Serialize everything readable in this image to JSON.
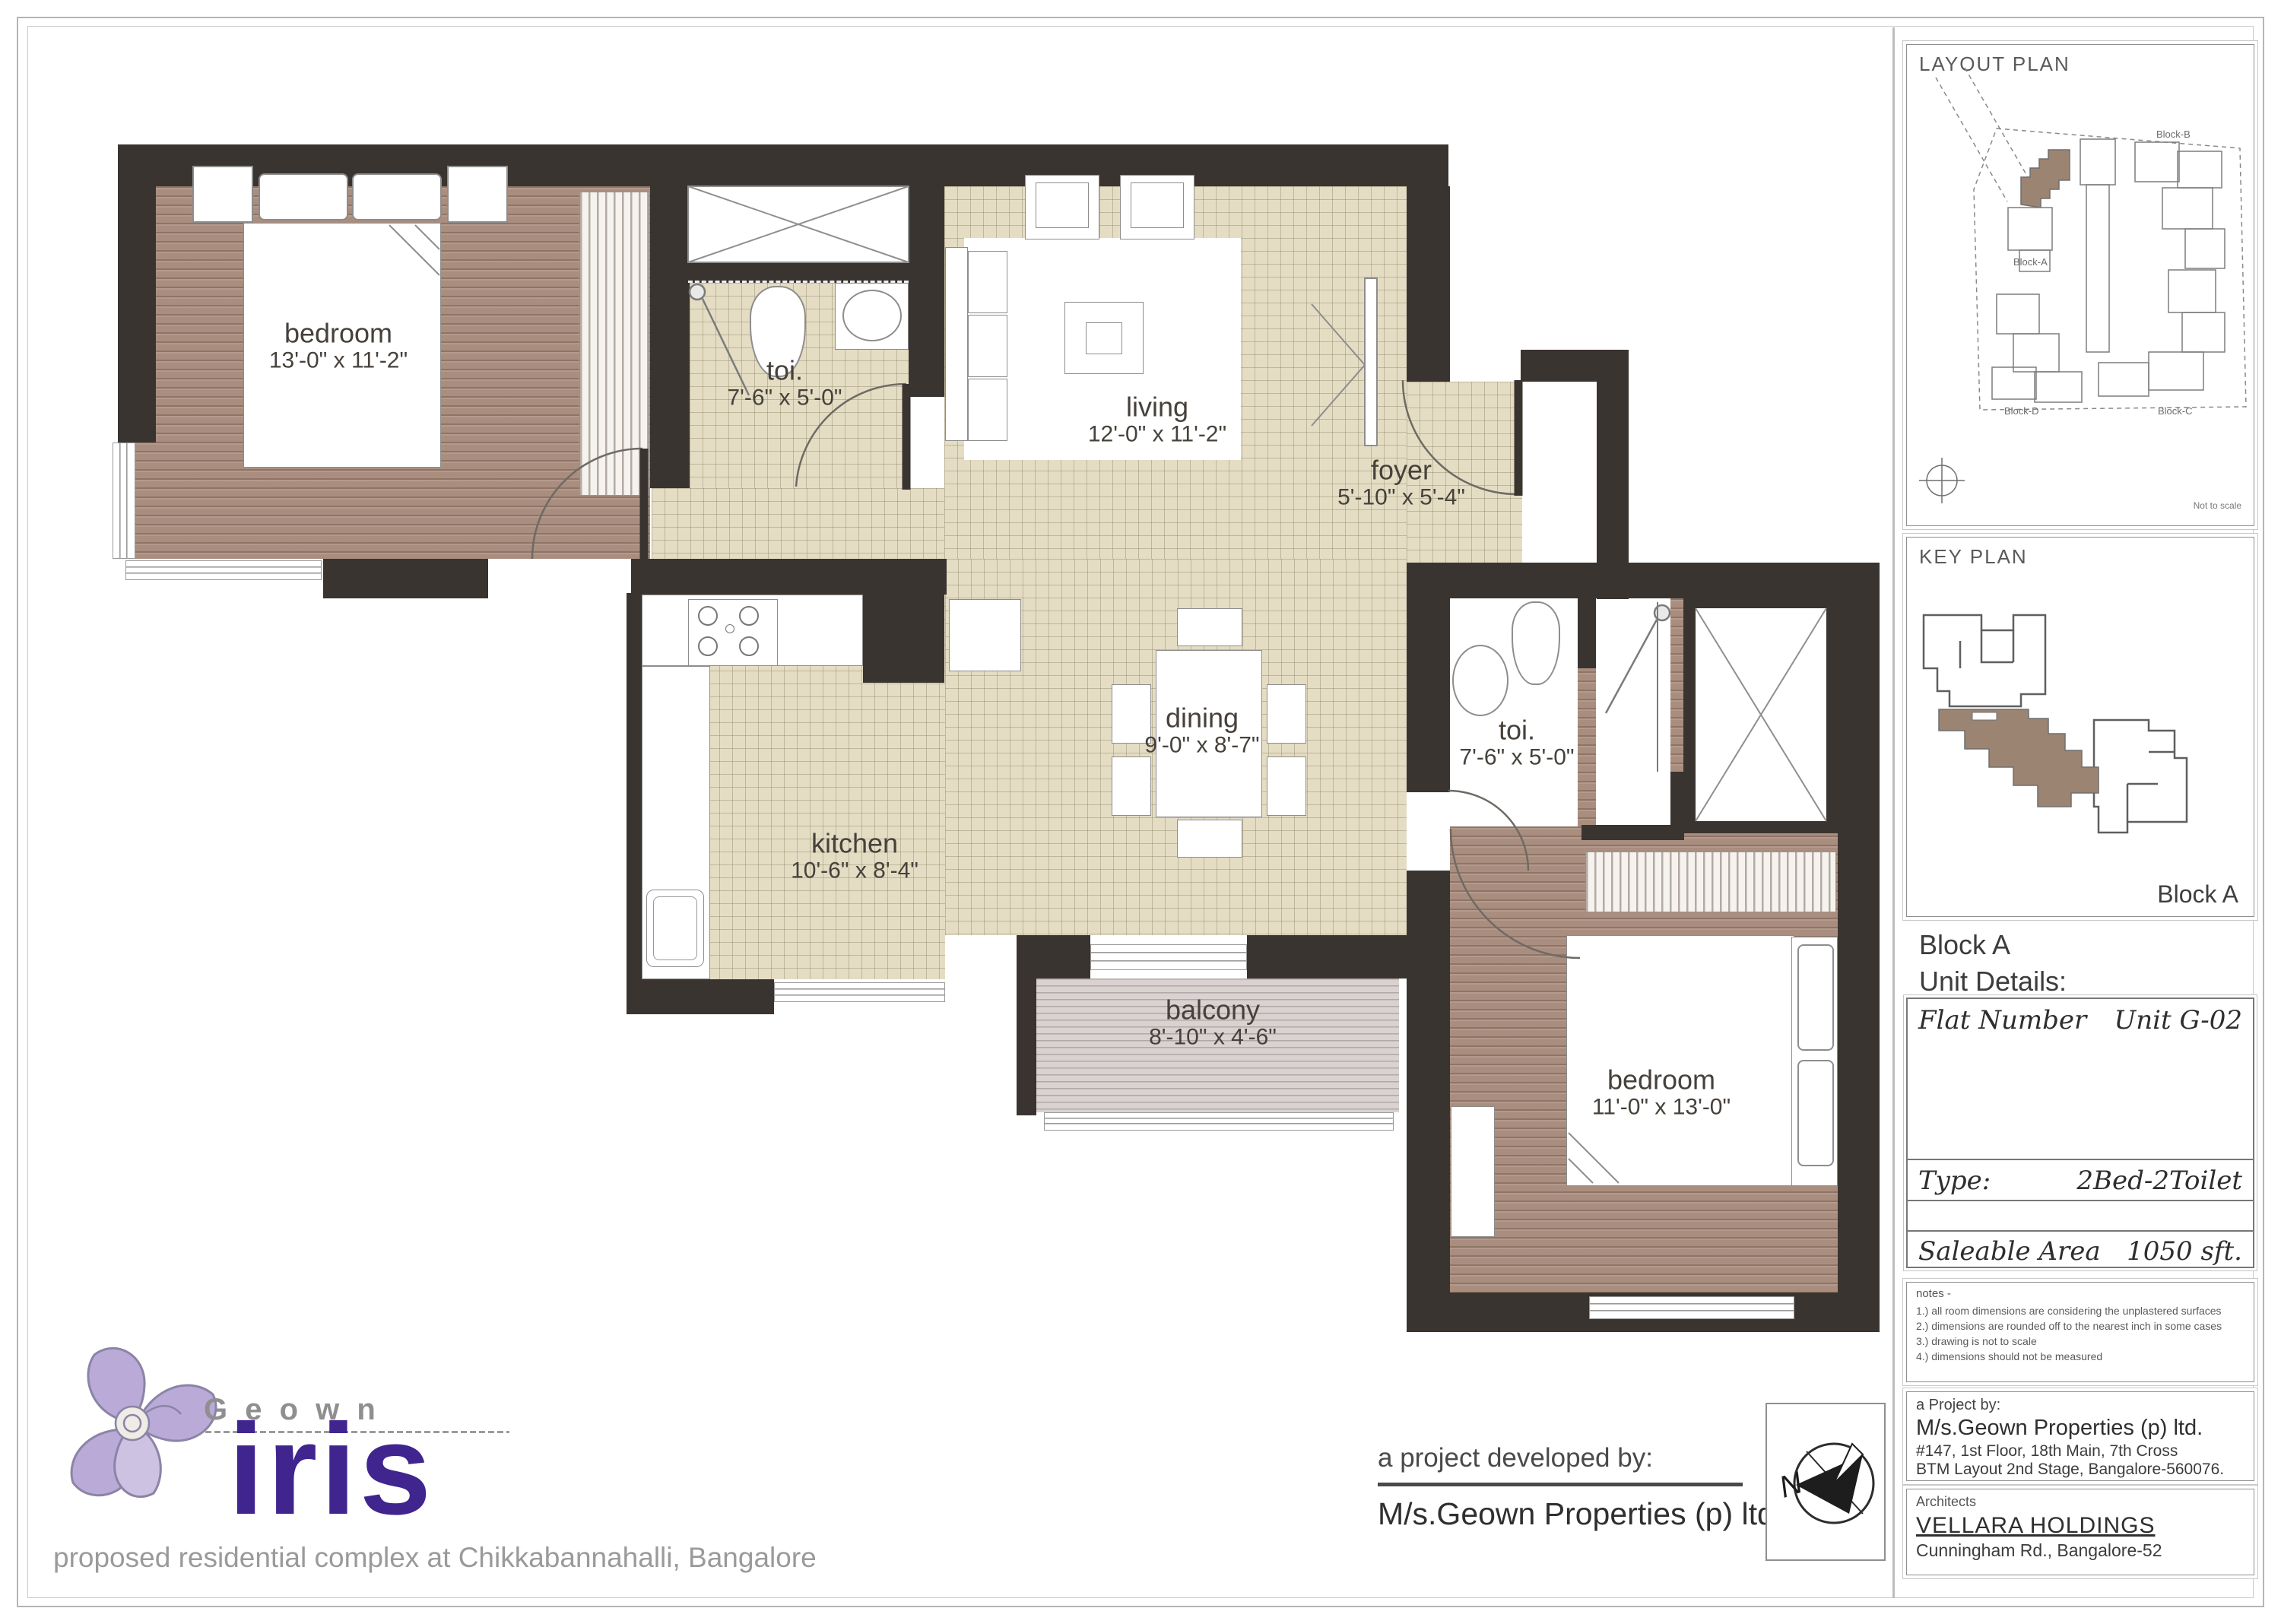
{
  "plan": {
    "rooms": [
      {
        "name": "bedroom",
        "dims": "13'-0\" x 11'-2\""
      },
      {
        "name": "toi.",
        "dims": "7'-6\" x 5'-0\""
      },
      {
        "name": "living",
        "dims": "12'-0\" x 11'-2\""
      },
      {
        "name": "foyer",
        "dims": "5'-10\" x 5'-4\""
      },
      {
        "name": "kitchen",
        "dims": "10'-6\" x 8'-4\""
      },
      {
        "name": "dining",
        "dims": "9'-0\" x 8'-7\""
      },
      {
        "name": "toi.",
        "dims": "7'-6\" x 5'-0\""
      },
      {
        "name": "bedroom",
        "dims": "11'-0\" x 13'-0\""
      },
      {
        "name": "balcony",
        "dims": "8'-10\" x 4'-6\""
      }
    ]
  },
  "sidebar": {
    "layout_plan": {
      "title": "LAYOUT PLAN",
      "block_b": "Block-B",
      "block_a": "Block-A",
      "block_d": "Block-D",
      "block_c": "Block-C",
      "scale_note": "Not to scale"
    },
    "key_plan": {
      "title": "KEY PLAN",
      "corner_label": "Block A"
    },
    "block_heading": "Block A",
    "unit_details_heading": "Unit Details:",
    "details": {
      "flat_label": "Flat Number",
      "flat_value": "Unit G-02",
      "type_label": "Type:",
      "type_value": "2Bed-2Toilet",
      "area_label": "Saleable Area",
      "area_value": "1050 sft."
    },
    "notes": {
      "heading": "notes -",
      "items": [
        "1.) all room dimensions are considering the unplastered surfaces",
        "2.) dimensions are rounded off to the nearest inch in some cases",
        "3.) drawing is not to scale",
        "4.) dimensions should not be measured"
      ]
    },
    "project": {
      "heading": "a Project by:",
      "name": "M/s.Geown Properties (p) ltd.",
      "address1": "#147, 1st Floor, 18th Main, 7th Cross",
      "address2": "BTM Layout 2nd Stage, Bangalore-560076."
    },
    "architects": {
      "heading": "Architects",
      "name": "VELLARA HOLDINGS",
      "address": "Cunningham Rd., Bangalore-52"
    }
  },
  "footer": {
    "brand": {
      "name": "G e o w n",
      "product": "iris",
      "tagline": "proposed residential complex at Chikkabannahalli, Bangalore"
    },
    "developer": {
      "heading": "a project developed by:",
      "name": "M/s.Geown Properties (p) ltd."
    },
    "compass": {
      "label": "N"
    }
  }
}
